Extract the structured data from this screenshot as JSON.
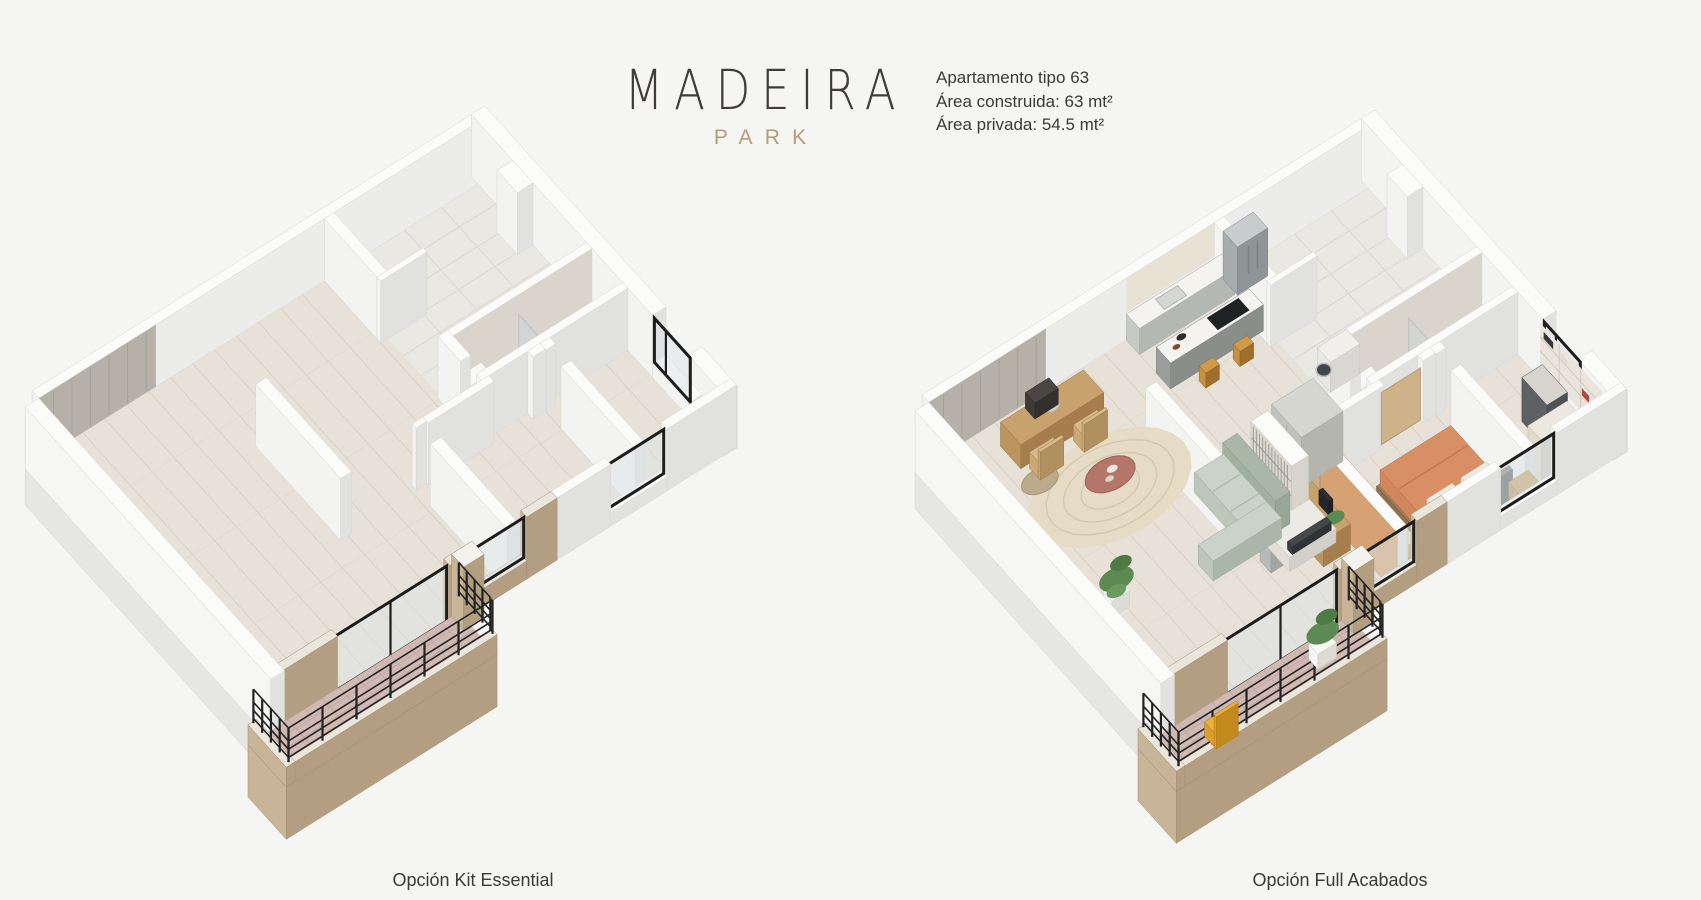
{
  "window": {
    "width": 1701,
    "height": 900
  },
  "brand": {
    "name": "MADEIRA",
    "sub": "PARK"
  },
  "apartment_info": {
    "line1": "Apartamento tipo  63",
    "line2": "Área construida: 63  mt²",
    "line3": "Área privada: 54.5 mt²"
  },
  "plans": [
    {
      "caption": "Opción Kit Essential",
      "style": "unfurnished"
    },
    {
      "caption": "Opción Full Acabados",
      "style": "furnished"
    }
  ],
  "colors": {
    "background": "#f5f5f3",
    "brand_ink": "#3f3c39",
    "brand_accent": "#b79b79",
    "text_ink": "#3a3a38",
    "floor_wood": "#e7e1d8",
    "floor_plank_line": "#d7d0c5",
    "floor_tile": "#eae8e3",
    "floor_tile_line": "#d8d5ce",
    "floor_tile_bath": "#e4e2dd",
    "wall_top": "#fbfbfa",
    "wall_light": "#f3f3f1",
    "wall_shade": "#e1e1df",
    "wall_edge": "#d6d6d3",
    "wall_inner": "#ececea",
    "wood_wall": "#b6b1a8",
    "brick_light": "#c8b496",
    "brick_dark": "#b39e81",
    "brick_top": "#eae6dc",
    "balcony_floor": "#cfb9b2",
    "balcony_tile_line": "#bba39c",
    "railing": "#232323",
    "frame": "#1d1d1d",
    "glass": "#dde4e6",
    "terracotta": "#d7a273",
    "cream_cabinet": "#e8e2d4",
    "counter_top": "#f4f3f0",
    "cabinet_face": "#b4b8b3",
    "island_face": "#8a8e8a",
    "steel": "#a7acae",
    "stool_wood": "#c9913f",
    "sofa": "#c9d3c7",
    "sofa_shade": "#aab7a8",
    "rug": "#e6dcc6",
    "rug_ring": "#d5c8ad",
    "coffee_table": "#b5766a",
    "bed_orange": "#d98f66",
    "bed_orange_side": "#c27a52",
    "headboard": "#6d7174",
    "wood_furniture": "#c8a26c",
    "wood_furniture_dark": "#a67e4e",
    "plant": "#5d8a53",
    "yellow_chair": "#e9b13a",
    "white_fixture": "#f6f6f4",
    "washer_door": "#41464a",
    "gray_wardrobe": "#c2c2bc"
  }
}
